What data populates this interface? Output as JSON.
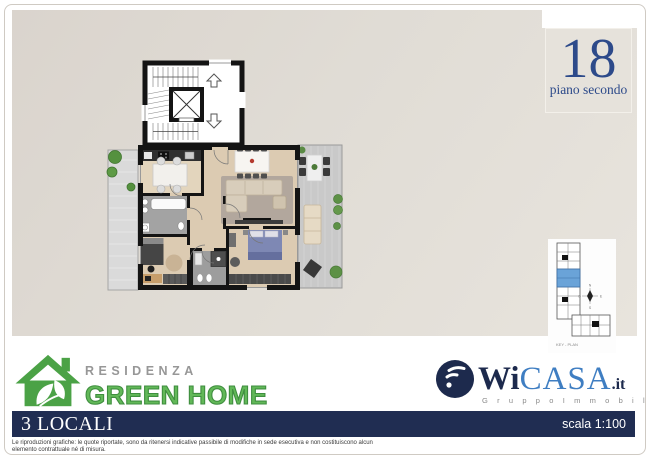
{
  "floor_card": {
    "number": "18",
    "label": "piano secondo",
    "color": "#2d4a8a"
  },
  "plan": {
    "description": "apartment-floor-plan",
    "wall_color": "#141414",
    "wood_floor": "#dccbb2",
    "bath_floor": "#a3a3a3",
    "terrace_floor": "#c9c9c9",
    "bed_blue": "#7e88b4"
  },
  "keyplan": {
    "caption": "KEY - PLAN",
    "highlight_color": "#6aa3d8",
    "compass": {
      "n": "N",
      "e": "E",
      "s": "S",
      "o": "O"
    }
  },
  "brand": {
    "residenza": "RESIDENZA",
    "name": "GREEN HOME",
    "green": "#4ba246",
    "grey": "#979797"
  },
  "agency": {
    "wi": "Wi",
    "casa": "CASA",
    "tld": ".it",
    "subtitle": "G r u p p o   I m m o b i l i a r e",
    "navy": "#1d2a4d",
    "blue": "#3f7ec2"
  },
  "footer": {
    "rooms": "3 LOCALI",
    "scale": "scala 1:100",
    "bar_color": "#202d52",
    "disclaimer_line1": "Le riproduzioni grafiche: le quote riportate, sono da ritenersi  indicative passibile di modifiche in sede esecutiva e non costituiscono alcun",
    "disclaimer_line2": "elemento contrattuale né di misura."
  }
}
